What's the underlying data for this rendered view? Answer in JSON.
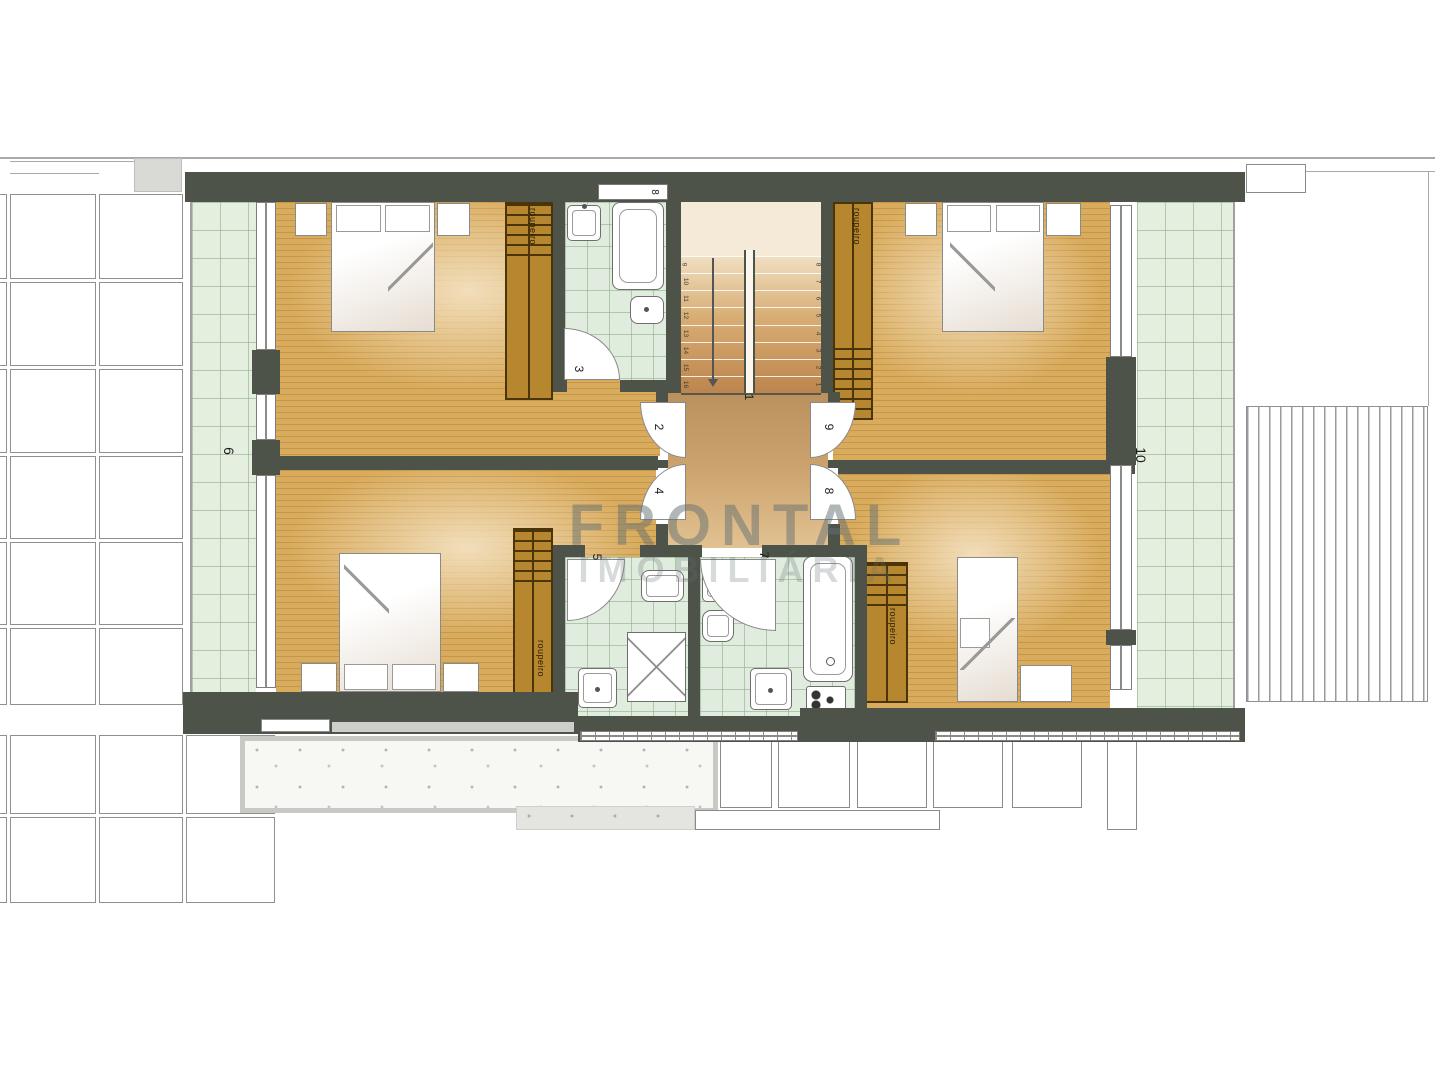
{
  "plan": {
    "watermark": {
      "line1": "FRONTAL",
      "line2": "IMOBILIÁRIA"
    },
    "labels": {
      "hall": "1",
      "door_bedroom_top_left": "2",
      "door_bathroom_top": "3",
      "door_bedroom_bottom_left": "4",
      "door_bathroom_bottom_left": "5",
      "balcony_left": "6",
      "door_bathroom_bottom_right": "7",
      "door_bedroom_bottom_right": "8",
      "door_bedroom_top_right": "9",
      "balcony_right": "10",
      "top_window": "8"
    },
    "wardrobe_label": "roupeiro",
    "stairs": {
      "left_flight_numbers_top_to_bottom": [
        "9",
        "10",
        "11",
        "12",
        "13",
        "14",
        "15",
        "16"
      ],
      "right_flight_numbers_top_to_bottom": [
        "8",
        "7",
        "6",
        "5",
        "4",
        "3",
        "2",
        "1"
      ]
    },
    "colors": {
      "wall": "#4d5348",
      "wood": "#d9ab5c",
      "wood_highlight": "#f2debb",
      "wood_line": "rgba(125,75,12,.22)",
      "balcony_tile": "#e4efe0",
      "bath_tile": "#e0ecde",
      "tile_line": "rgba(139,166,134,.55)",
      "wardrobe": "#b6872f",
      "wardrobe_line": "#4a3408",
      "watermark": "rgba(100,112,114,.5)",
      "watermark_faint": "rgba(100,112,114,.26)"
    }
  }
}
